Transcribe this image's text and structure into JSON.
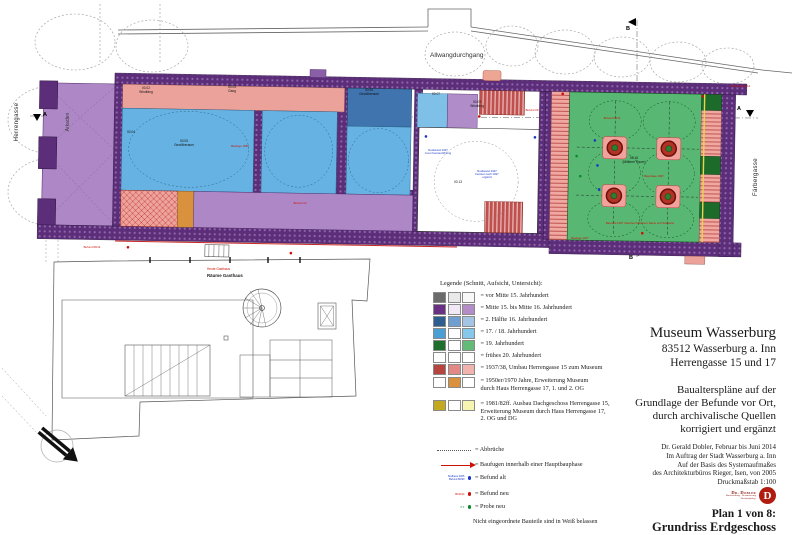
{
  "plan": {
    "streets": {
      "left": "Herrengasse",
      "right": "Färbergasse",
      "passage": "Allwangdurchgang"
    },
    "area_labels": {
      "arkaden": "Arkaden",
      "gasthaus_red": "Heute Gasthaus",
      "gasthaus_black": "Räume Gasthaus"
    },
    "markers": {
      "a": "A",
      "b": "B"
    },
    "room_labels": [
      "00.02\nWindfang",
      "00.03\nGang",
      "00.04",
      "00.05\nGewölberaum",
      "00.06\nGewölberaum",
      "00.07",
      "00.09\nWindfang",
      "00.13",
      "00.16\n(Mittlerer Raum)"
    ],
    "annotations": [
      {
        "color": "red",
        "text": "Baufuge 1580"
      },
      {
        "color": "red",
        "text": "Befund 80/14"
      },
      {
        "color": "blue",
        "text": "Nordwand 1937\nzuvor Fensteröffnung"
      },
      {
        "color": "blue",
        "text": "Nordwand 1937\nFenster nach 1937\nergänzt"
      },
      {
        "color": "red",
        "text": "Baufuge 1937"
      },
      {
        "color": "red",
        "text": "Befund 09/14"
      },
      {
        "color": "red",
        "text": "Bauphase 1937"
      },
      {
        "color": "red",
        "text": "Nordostwand 14"
      },
      {
        "color": "red",
        "text": "Befund 09"
      },
      {
        "color": "red",
        "text": "Befund 12"
      },
      {
        "color": "red",
        "text": "Baunaht 1937 zwischen Mittlerem Raum und Südwand"
      }
    ]
  },
  "legend": {
    "title": "Legende (Schnitt, Aufsicht, Untersicht):",
    "rows": [
      {
        "swatches": [
          "#6b6b6b",
          "#e9e9e9",
          "#f8f8f8"
        ],
        "label": "= vor Mitte 15. Jahrhundert"
      },
      {
        "swatches": [
          "#6a3084",
          "#f1e8f6",
          "#b48cc8"
        ],
        "label": "= Mitte 15. bis Mitte 16. Jahrhundert"
      },
      {
        "swatches": [
          "#2d5e8f",
          "#6f9fd0",
          "#a3c4e2"
        ],
        "label": "= 2. Hälfte 16. Jahrhundert"
      },
      {
        "swatches": [
          "#4a9fd4",
          "#ffffff",
          "#85c8ec"
        ],
        "label": "= 17. / 18. Jahrhundert"
      },
      {
        "swatches": [
          "#1e6f2e",
          "#ffffff",
          "#62bb76"
        ],
        "label": "= 19. Jahrhundert"
      },
      {
        "swatches": [
          "#ffffff",
          "#ffffff",
          "#ffffff"
        ],
        "label": "= frühes 20. Jahrhundert"
      },
      {
        "swatches": [
          "#b64540",
          "#e08985",
          "#f2b3ae"
        ],
        "label": "= 1937/38, Umbau Herrengasse 15 zum Museum"
      },
      {
        "swatches": [
          "#ffffff",
          "#d9913d",
          "#ffffff"
        ],
        "label": "= 1950er/1970 Jahre, Erweiterung Museum\ndurch Haus Herrengasse 17, 1. und 2. OG"
      },
      {
        "swatches": [
          "#c3a91f",
          "#ffffff",
          "#f7f3b0"
        ],
        "label": "= 1981/82ff. Ausbau Dachgeschoss Herrengasse 15,\nErweiterung Museum durch Haus Herrengasse 17,\n2. OG und DG"
      }
    ],
    "symbol_rows": [
      {
        "label": "= Abbrüche"
      },
      {
        "label": "= Baufugen innerhalb einer Hauptbauphase"
      },
      {
        "tiny": "Südhaus 2005\nBefund 80/90",
        "label": "= Befund alt"
      },
      {
        "tiny": "80/2014",
        "label": "= Befund neu"
      },
      {
        "tiny": "P 1",
        "label": "= Probe neu"
      }
    ],
    "footer": "Nicht eingeordnete Bauteile sind in Weiß belassen",
    "symbol_colors": {
      "befund_alt": "#1837c8",
      "befund_neu": "#cc1208",
      "probe_neu": "#0a8a2a"
    }
  },
  "title_block": {
    "line1": "Museum Wasserburg",
    "line2": "83512 Wasserburg a. Inn",
    "line3": "Herrengasse 15 und 17",
    "paragraph": "Baualterspläne auf der\nGrundlage der Befunde vor Ort,\ndurch archivalische Quellen\nkorrigiert und ergänzt",
    "credits": "Dr. Gerald Dobler, Februar bis Juni 2014\nIm Auftrag der Stadt Wasserburg a. Inn\nAuf der Basis des Systemaufmaßes\ndes Architekturbüros Rieger, Isen, von 2005\nDruckmaßstab 1:100",
    "logo_line1": "Dr. Dobler",
    "logo_line2": "Bauforschung · Restaurierung\nDenkmalpflege",
    "logo_glyph": "D",
    "plan_no": "Plan 1 von 8:",
    "plan_name": "Grundriss Erdgeschoss"
  },
  "colors": {
    "wall_purple": "#5c2d79",
    "arcade_purple": "#ae87c6",
    "blue_17_18": "#66b3e3",
    "blue_16": "#3f74ae",
    "green_19": "#58b873",
    "dark_green": "#1c6b2a",
    "pink_1937": "#eba29b",
    "red_1937": "#c0504d",
    "orange_1950": "#d9913d",
    "yellow_1981": "#e8d44d"
  }
}
